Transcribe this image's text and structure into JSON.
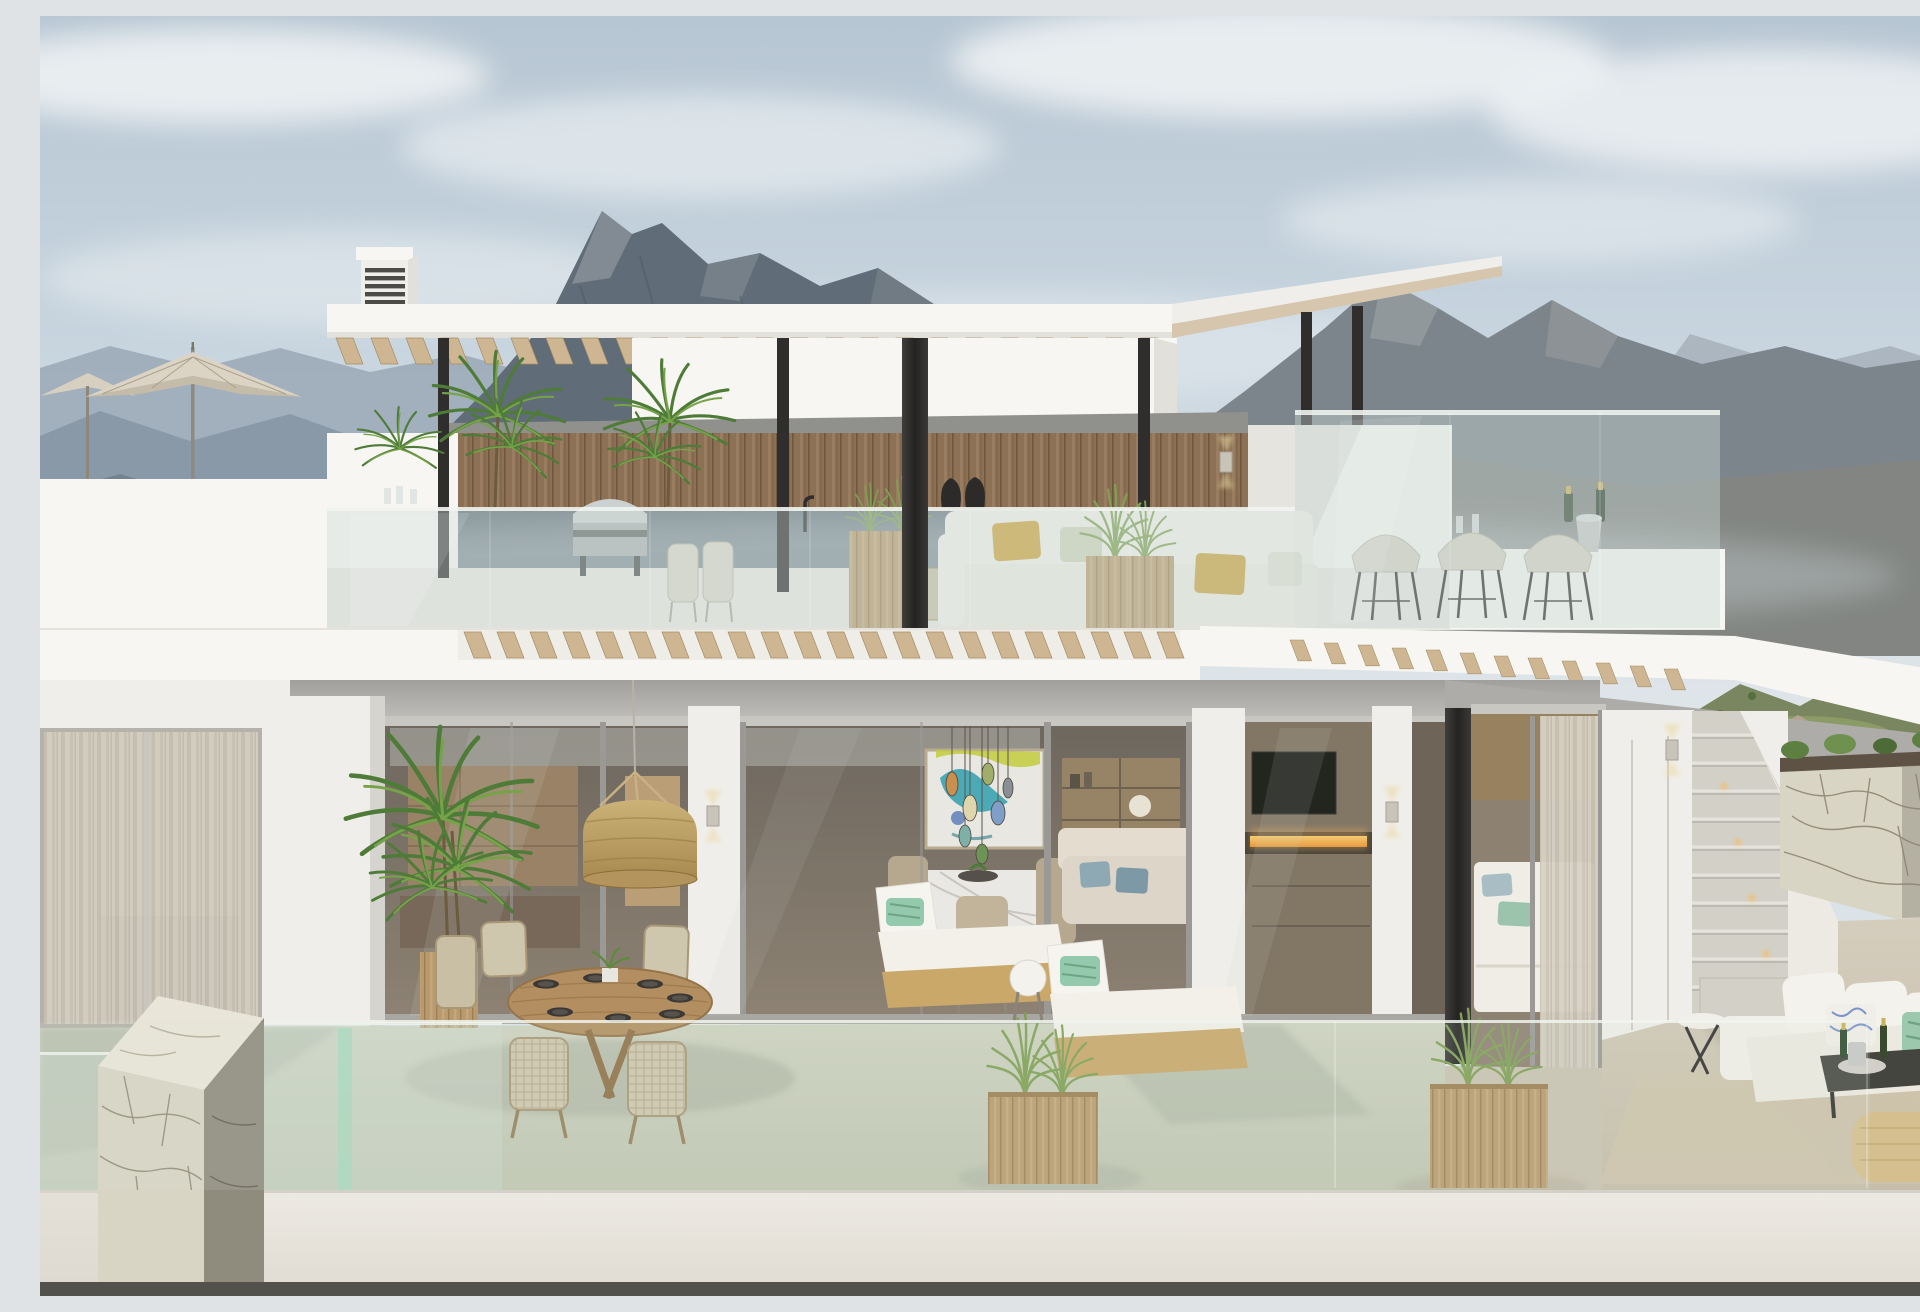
{
  "meta": {
    "description": "Photorealistic 3D architectural rendering of a modern two-storey white villa with a rooftop terrace, pergola, outdoor bar and lower terrace, set against hazy mountain ranges under a pale blue sky."
  },
  "palette": {
    "sky_top": "#b7c6d3",
    "sky_mid": "#c9d6e0",
    "sky_low": "#dbe3e8",
    "cloud": "#f0f3f5",
    "mtn_far_left": "#9fadb9",
    "mtn_mid_left": "#8999a7",
    "mtn_peak": "#606c77",
    "mtn_peak_lit": "#8d969e",
    "mtn_right": "#7d858c",
    "mtn_right_far": "#a6b0ba",
    "mtn_right_warm": "#8a8574",
    "hills_green": "#7a8660",
    "hills_green_lit": "#93a468",
    "white_sun": "#f7f6f2",
    "white_bright": "#f0eeea",
    "white_shade": "#e2e0db",
    "soffit_dark": "#a19f9b",
    "soffit_light": "#c9c7c3",
    "wood_wall": "#8d7155",
    "wood_slat": "#cdb691",
    "wood_slat_dark": "#a68d66",
    "wood_warm": "#b99a6f",
    "steel_black": "#2f2e2d",
    "glass_tint": "#ccdcd6",
    "glass_green": "#a8d8bc",
    "interior_top": "#6e675e",
    "interior_bot": "#8d8273",
    "fire_hi": "#f6d27c",
    "fire_lo": "#e08f2e",
    "tv": "#23251f",
    "art_teal": "#2f9fae",
    "art_yellow": "#c2cc3c",
    "art_blue": "#3e6ab0",
    "marble": "#eae8e4",
    "floor_sage": "#c8cdb9",
    "floor_beige": "#cdc4b3",
    "stone_light": "#d9d5c5",
    "stone_top": "#e9e6d9",
    "stone_side": "#8f8b7d",
    "stone_crack": "#837c69",
    "curtain_a": "#d7d1c5",
    "curtain_b": "#c7c0b2",
    "rattan_hi": "#ccb277",
    "rattan_lo": "#a5874c",
    "cushion": "#f1efe9",
    "pillow_yellow": "#cda43f",
    "pillow_green": "#93c9ad",
    "pillow_blue": "#8fa9b4",
    "pouf": "#d6bf8e",
    "plant_dark": "#4e7c38",
    "plant_light": "#76a348",
    "grass": "#7fa054",
    "umbrella": "#dbd3c4",
    "deck": "#e9e7e2",
    "bottom_strip": "#53514c",
    "glow": "#ead9a4"
  },
  "scene": {
    "sky": "pale blue sky with soft clouds",
    "mountains": "layered hazy mountain ridges left, dark rocky peak centre, brown-grey range right",
    "rooftop": "roof terrace with parasol, chimney vent, white pergola on black steel columns, timber-clad outdoor kitchen with barbecue, white lounge sofa with ochre pillows, planters with grasses, glass balustrade, glass wind-screen bar with three stools and champagne",
    "lower_level": "floor-to-ceiling glazing showing kitchen, dining room with colourful pendant cluster and abstract art, living room with fireplace and TV, bedroom with sheer curtains; terrace with rattan pendant, round timber dining table, two sun loungers, timber planters, outdoor sofa set, external staircase with step lights and natural stone retaining wall",
    "foreground": "sage-green terrace deck behind frameless glass railing, stone pier with glass panels, white parapet band"
  }
}
